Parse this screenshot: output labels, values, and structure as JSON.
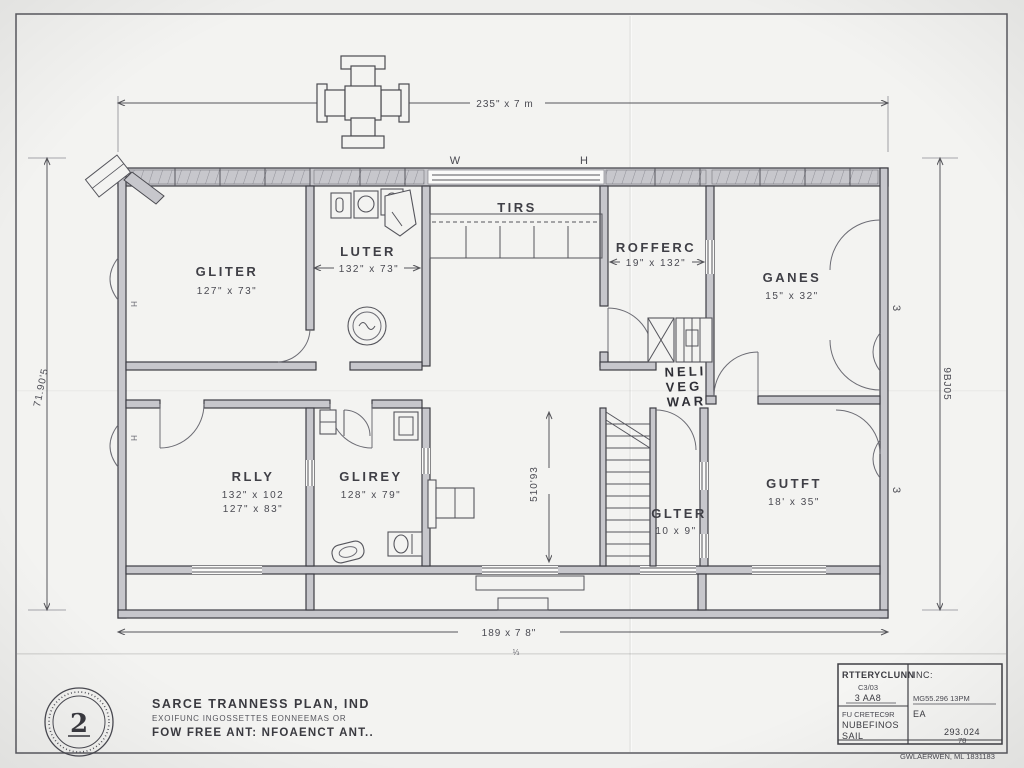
{
  "plan": {
    "dims": {
      "top": "235\" x 7 m",
      "bottom": "189 x 7 8\"",
      "bottom_mark": "⅓",
      "left": "71.90'5",
      "right": "9BJ05",
      "hall": "510'93",
      "luter": "132\" x 73\"",
      "rofferc": "19\" x 132\""
    },
    "wall_letters": {
      "w": "W",
      "h": "H",
      "e1": "3",
      "e2": "3",
      "h1": "H",
      "h2": "H"
    },
    "rooms": {
      "gliter": {
        "name": "GLITER",
        "size": "127\" x 73\""
      },
      "luter": {
        "name": "LUTER"
      },
      "tirs": {
        "name": "TIRS"
      },
      "rofferc": {
        "name": "ROFFERC"
      },
      "ganes": {
        "name": "GANES",
        "size": "15\" x 32\""
      },
      "neli": {
        "l1": "NELI",
        "l2": "VEG",
        "l3": "WAR"
      },
      "rlly": {
        "name": "RLLY",
        "size1": "132\" x 102",
        "size2": "127\" x 83\""
      },
      "glirey": {
        "name": "GLIREY",
        "size": "128\" x 79\""
      },
      "glter": {
        "name": "GLTER",
        "size": "10 x 9\""
      },
      "gutft": {
        "name": "GUTFT",
        "size": "18' x 35\""
      }
    }
  },
  "footer": {
    "stamp_glyph": "2",
    "firm1": "SARCE TRANNESS PLAN, IND",
    "firm2": "EXOIFUNC INGOSSETTES EONNEEMAS OR",
    "firm3": "FOW FREE ANT: NFOAENCT ANT.."
  },
  "title_block": {
    "company": "RTTERYCLUNN",
    "inc": "INC:",
    "l1a": "C3/03",
    "l1b": "3 AA8",
    "r1": "MG55.296 13PM",
    "l2a": "FU CRETEC9R",
    "l2b": "NUBEFINOS",
    "r2": "EA",
    "l3": "SAIL",
    "r3": "293.024",
    "r3b": "78",
    "below": "GWLAERWEN, ML 1831183"
  }
}
